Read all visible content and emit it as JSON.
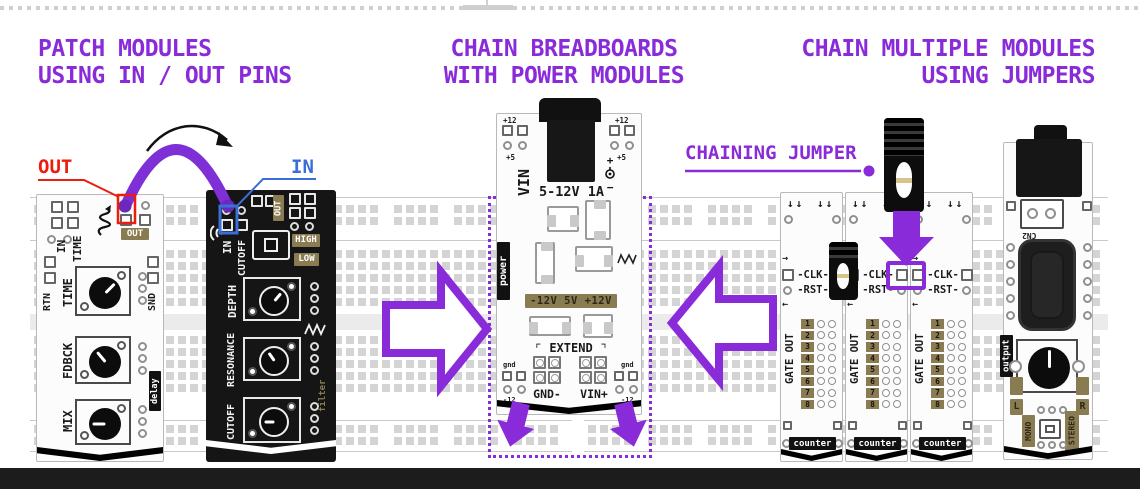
{
  "colors": {
    "purple": "#8a2bd9",
    "red": "#ee1c0e",
    "blue": "#3a6fd8",
    "olive_label": "#8a7c52",
    "pcb_black": "#151515",
    "breadboard_pad": "#d4d4d4",
    "footer_bar": "#1c1c1c"
  },
  "headings": {
    "left": {
      "line1": "PATCH MODULES",
      "line2": "USING IN / OUT PINS"
    },
    "center": {
      "line1": "CHAIN BREADBOARDS",
      "line2": "WITH POWER MODULES"
    },
    "right": {
      "line1": "CHAIN MULTIPLE MODULES",
      "line2": "USING JUMPERS"
    }
  },
  "callouts": {
    "out": "OUT",
    "in": "IN",
    "chaining_jumper": "CHAINING JUMPER"
  },
  "icons": {
    "down_arrows": "↓↓",
    "arrow_right": "→",
    "arrow_left": "←",
    "plus": "+",
    "minus": "−"
  },
  "delay_module": {
    "name": "delay",
    "top_pin_labels": [
      "IN",
      "TIME"
    ],
    "out_pad": "OUT",
    "left_pin": "RTN",
    "right_pin": "SND",
    "knobs": [
      "TIME",
      "FDBCK",
      "MIX"
    ]
  },
  "filter_module": {
    "name": "filter",
    "in_pin": "IN",
    "cutoff_pin": "CUTOFF",
    "out_pad": "OUT",
    "modes": [
      "HIGH",
      "LOW"
    ],
    "knobs": [
      "DEPTH",
      "RESONANCE",
      "CUTOFF"
    ]
  },
  "power_module": {
    "name": "power",
    "vin": "VIN",
    "rating": "5-12V 1A",
    "plus12": "+12",
    "plus5": "+5",
    "rails": "-12V 5V +12V",
    "extend": "⌜ EXTEND ⌝",
    "headers": [
      "GND-",
      "VIN+"
    ],
    "gnd": "gnd",
    "neg12": "-12"
  },
  "counter_module": {
    "name": "counter",
    "clk": "-CLK-",
    "rst": "-RST-",
    "gate_out": "GATE OUT",
    "pins": [
      "1",
      "2",
      "3",
      "4",
      "5",
      "6",
      "7",
      "8"
    ]
  },
  "output_module": {
    "name": "output",
    "cn2": "CN2",
    "left": "L",
    "right": "R",
    "mono": "MONO",
    "stereo": "STEREO"
  }
}
